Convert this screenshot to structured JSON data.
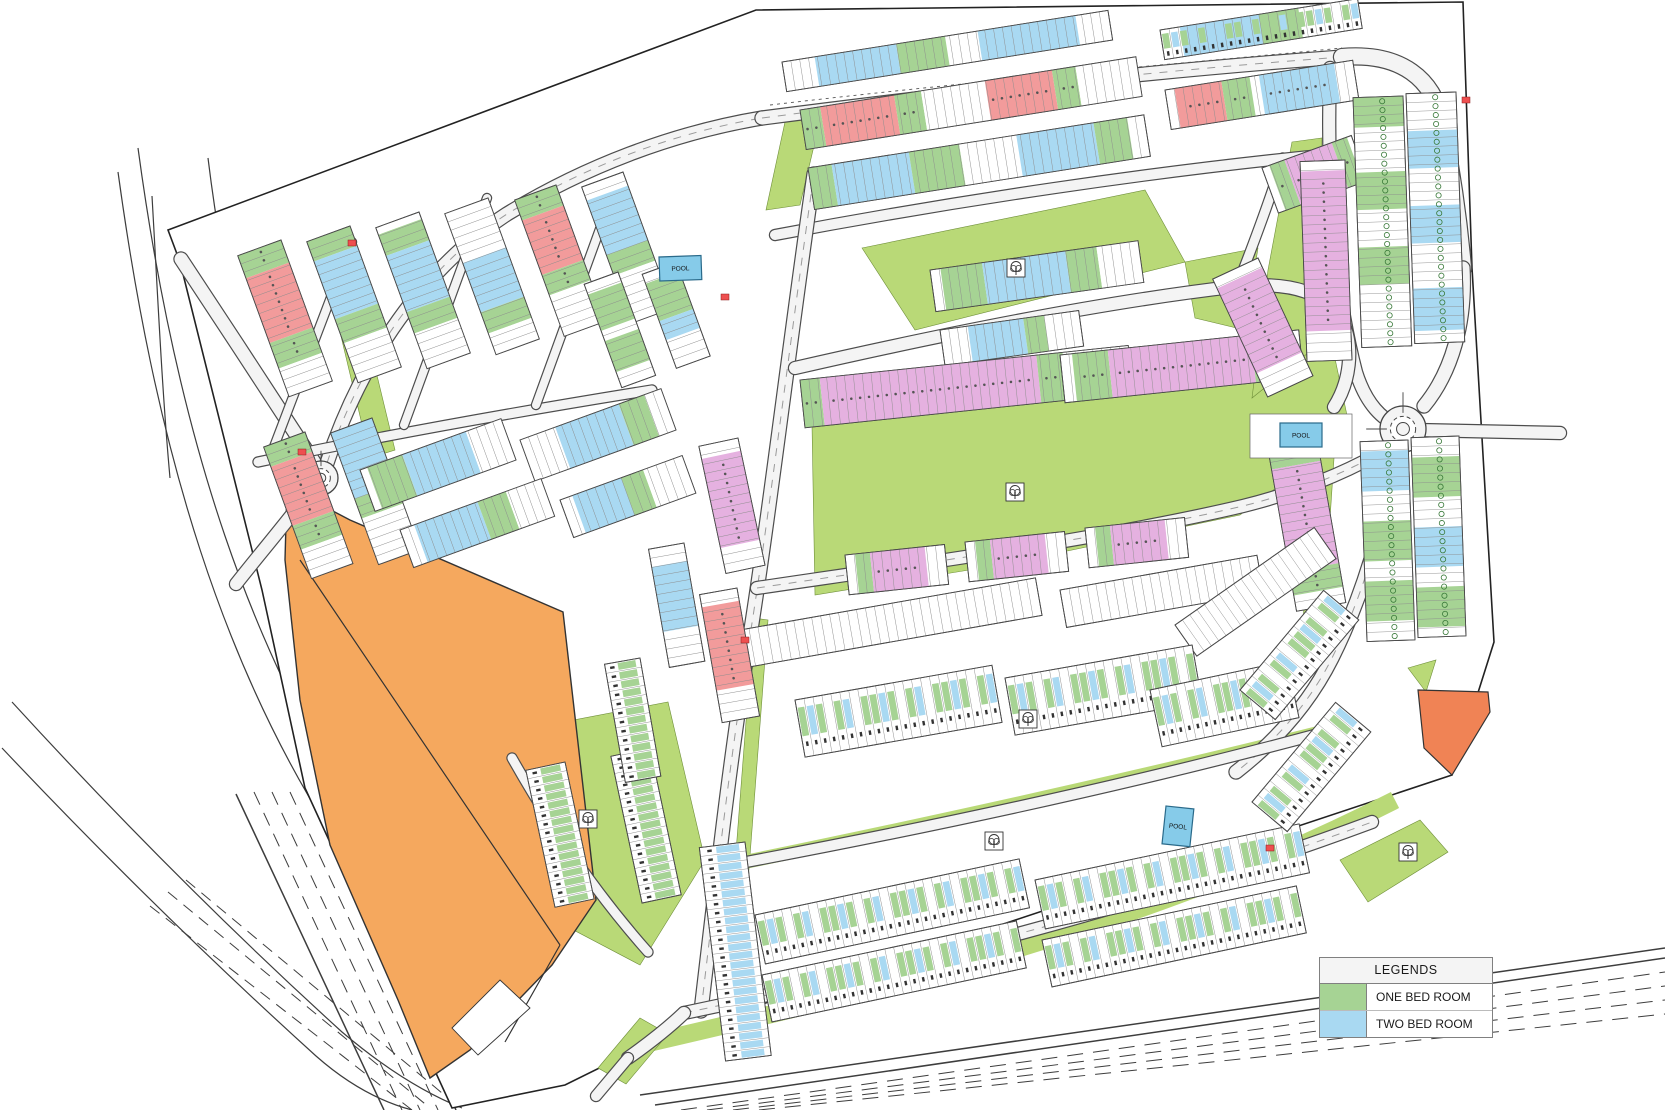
{
  "legend": {
    "title": "LEGENDS",
    "items": [
      {
        "label": "ONE BED ROOM",
        "color_key": "one_bed_green"
      },
      {
        "label": "TWO BED ROOM",
        "color_key": "two_bed_blue"
      }
    ]
  },
  "labels": {
    "pool": "POOL"
  },
  "colors": {
    "one_bed_green": "#a6d394",
    "two_bed_blue": "#a9d9f2",
    "red_unit": "#f29b9b",
    "violet_unit": "#e5b1e0",
    "green_space": "#b9d977",
    "orange_parcel": "#f5a85e",
    "orange_parcel_2": "#f08355",
    "pool_blue": "#86cbe9",
    "road_fill": "#f4f4f4",
    "outline": "#444444",
    "red_mark": "#ee4f4f"
  }
}
